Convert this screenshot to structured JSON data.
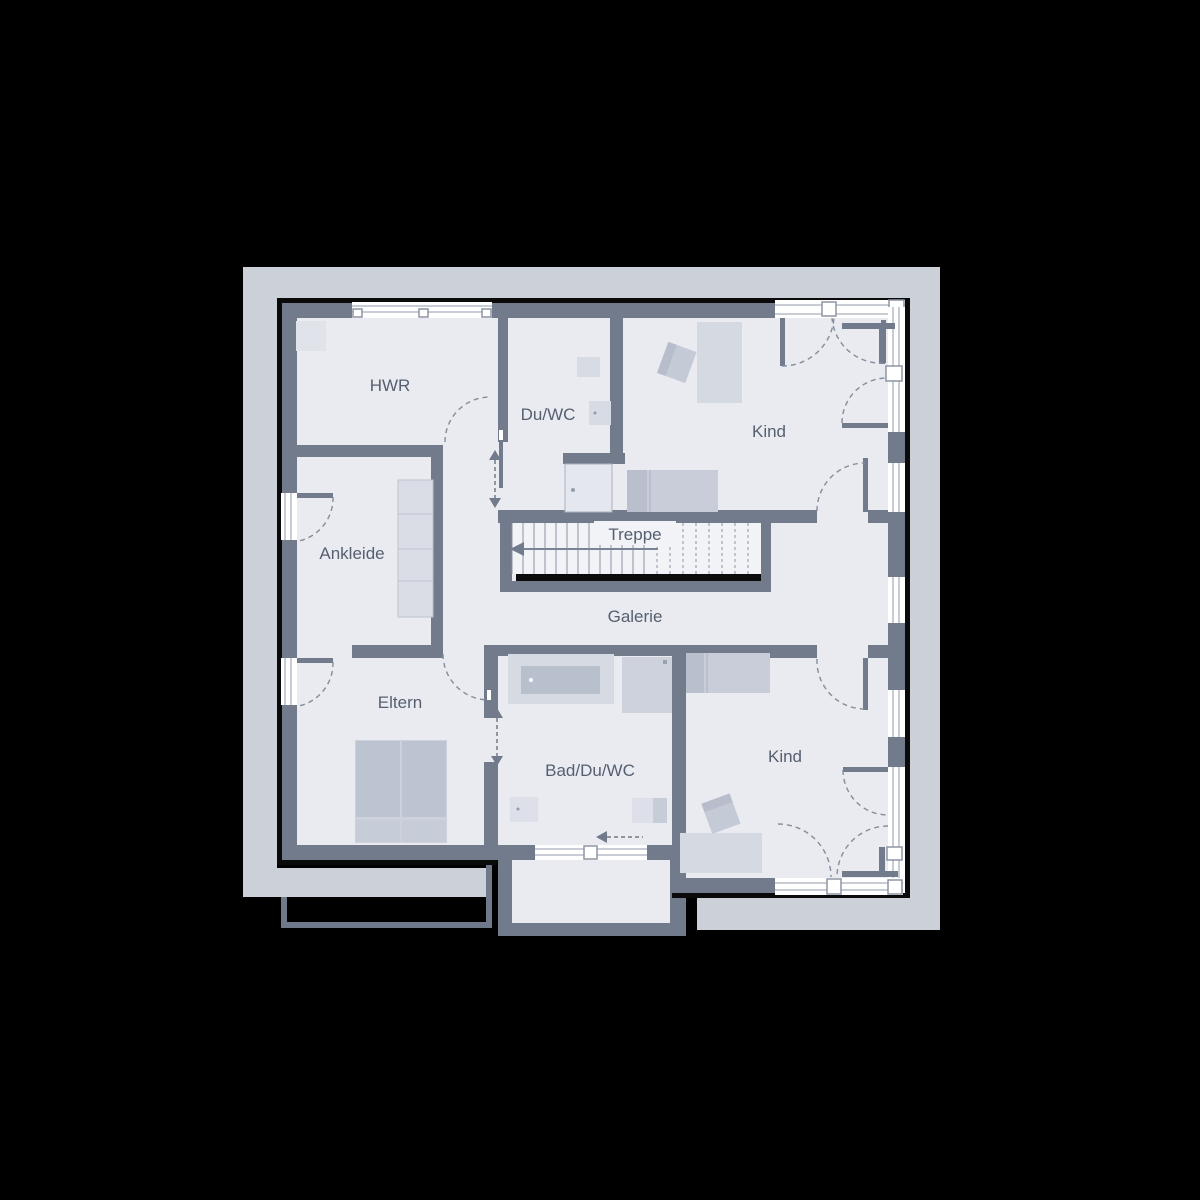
{
  "drawing": {
    "kind": "residential upper-floor plan",
    "rooms": [
      {
        "id": "hwr",
        "label": "HWR"
      },
      {
        "id": "du-wc",
        "label": "Du/WC"
      },
      {
        "id": "kind-1",
        "label": "Kind"
      },
      {
        "id": "ankleide",
        "label": "Ankleide"
      },
      {
        "id": "treppe",
        "label": "Treppe"
      },
      {
        "id": "galerie",
        "label": "Galerie"
      },
      {
        "id": "eltern",
        "label": "Eltern"
      },
      {
        "id": "bad-du-wc",
        "label": "Bad/Du/WC"
      },
      {
        "id": "kind-2",
        "label": "Kind"
      }
    ],
    "colors": {
      "background": "#000000",
      "border_band": "#ccd0d9",
      "floor": "#e9ebf1",
      "stair_floor": "#f1f3f7",
      "wall": "#717b8b",
      "outline": "#0a0a0b",
      "window": "#ffffff",
      "furniture_light": "#d5d9e2",
      "furniture_mid": "#c8cdd9",
      "furniture_dark": "#b9bfcd",
      "label_text": "#565f6f"
    }
  }
}
